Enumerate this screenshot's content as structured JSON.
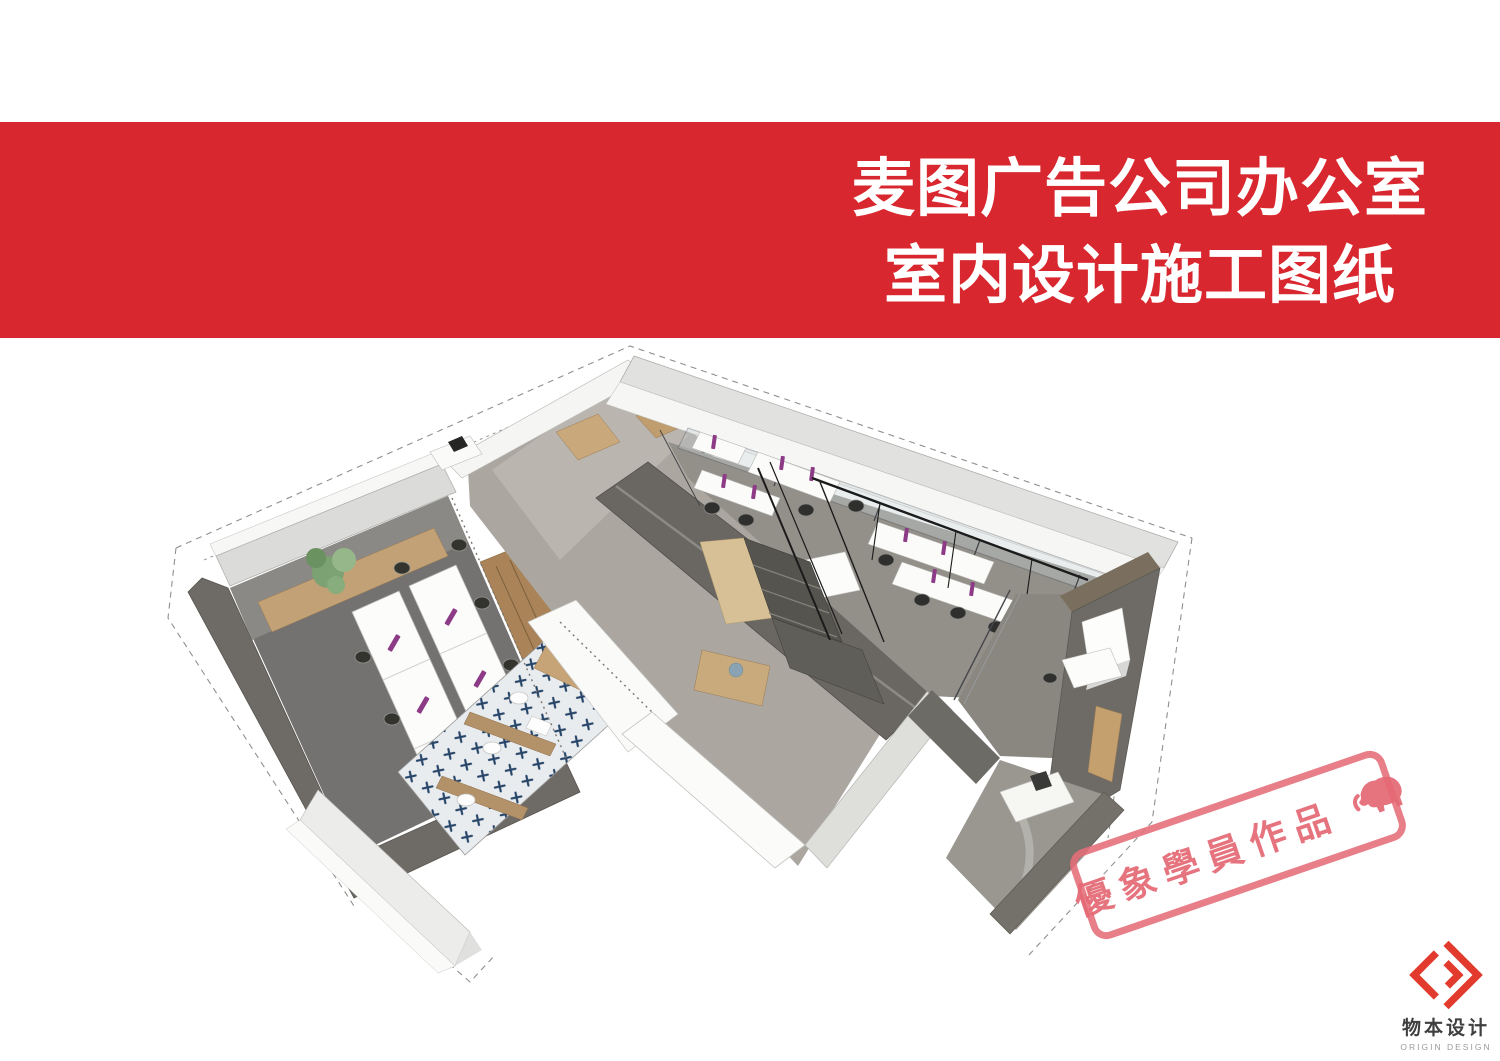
{
  "slide": {
    "banner": {
      "title_lines": [
        "麦图广告公司办公室",
        "室内设计施工图纸"
      ],
      "background_color": "#d8272e",
      "text_color": "#ffffff"
    },
    "stamp": {
      "text": "優象學員作品",
      "icon": "elephant-icon",
      "color": "#e56d78"
    },
    "logo": {
      "name_cn": "物本设计",
      "name_en": "ORIGIN DESIGN",
      "mark_color": "#e23a2d"
    }
  }
}
